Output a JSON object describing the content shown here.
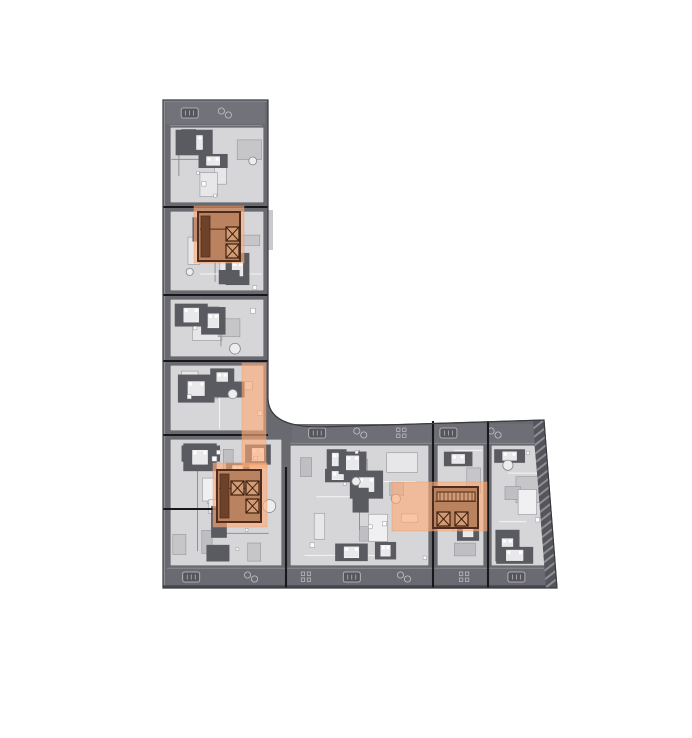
{
  "page": {
    "background": "#ffffff"
  },
  "palette": {
    "shell": "#696970",
    "shell_stroke": "#3a3a40",
    "interior": "#d6d6d8",
    "interior_stroke": "#4f4f56",
    "room_fills": [
      "#c6c6c9",
      "#e7e7e9",
      "#f0f0f2",
      "#bfbfc3"
    ],
    "room_stroke": "#97979d",
    "dark_block": "#5a5a61",
    "bed_fill": "#e9e9eb",
    "wall_line": "#8f8f95",
    "light_line": "#f4f4f6",
    "circle_fill": "#ededef",
    "circle_stroke": "#86868c",
    "tiny_fill": "#fbfbfc",
    "tiny_stroke": "#9a9aa0",
    "band_detail": "#c3c3c7",
    "band_dark": "#55555c",
    "divider": "#18181c",
    "hatch_base": "#54545b",
    "hatch_stripe": "#8e8e94",
    "edge_light": "#9c9ca2",
    "edge_mid": "#8c8c92",
    "edge_dark": "#47474d",
    "sliver": "#c9c9cc",
    "highlight": "#ffab74",
    "highlight_opacity": 0.62,
    "highlight_stroke": "#e09a70",
    "core": {
      "floor": "#bb8260",
      "wall": "#4e2d1e",
      "box": "#d49a73",
      "x": "#3c2212",
      "cab": "#6e4129",
      "box_w": 13,
      "box_h": 14
    }
  },
  "floorplan": {
    "canvas": {
      "w": 692,
      "h": 738
    },
    "outline_path": "M 163,100 L 268,100 L 268,398 Q 268,427 320,427 L 544,420 L 557,588 L 163,588 Z",
    "hatch_polygon": "533,421 544,420 557,588 546,588",
    "modules": [
      {
        "id": "m1",
        "x": 170,
        "y": 127,
        "w": 94,
        "h": 76,
        "seed": 101
      },
      {
        "id": "m2",
        "x": 170,
        "y": 211,
        "w": 94,
        "h": 80,
        "seed": 202
      },
      {
        "id": "m3",
        "x": 170,
        "y": 299,
        "w": 94,
        "h": 58,
        "seed": 303
      },
      {
        "id": "m4",
        "x": 170,
        "y": 365,
        "w": 94,
        "h": 66,
        "seed": 404
      },
      {
        "id": "corner",
        "x": 170,
        "y": 439,
        "w": 112,
        "h": 127,
        "seed": 505
      },
      {
        "id": "h1",
        "x": 290,
        "y": 445,
        "w": 139,
        "h": 121,
        "seed": 606
      },
      {
        "id": "h2",
        "x": 437,
        "y": 445,
        "w": 47,
        "h": 121,
        "seed": 707
      },
      {
        "id": "h3",
        "x": 491,
        "y": 445,
        "w": 55,
        "h": 121,
        "seed": 808,
        "clip": "491,445 535,445 546,566 491,566"
      }
    ],
    "bands": [
      {
        "id": "top-terrace",
        "x": 166,
        "y": 102,
        "w": 99,
        "h": 22,
        "seed": 11,
        "step": 34,
        "fill": "#72727a"
      },
      {
        "id": "south-terrace",
        "x": 292,
        "y": 424,
        "w": 244,
        "h": 18,
        "seed": 22,
        "step": 48,
        "fill": "#6e6e76"
      },
      {
        "id": "bottom-facade",
        "x": 167,
        "y": 569,
        "w": 382,
        "h": 16,
        "seed": 33,
        "step": 52,
        "fill": "#6a6a72"
      }
    ],
    "dividers": [
      [
        163,
        207,
        268,
        207
      ],
      [
        163,
        295,
        268,
        295
      ],
      [
        163,
        361,
        268,
        361
      ],
      [
        163,
        435,
        268,
        435
      ],
      [
        163,
        509,
        217,
        509
      ],
      [
        286,
        467,
        286,
        588
      ],
      [
        433,
        421,
        433,
        588
      ],
      [
        488,
        421,
        488,
        588
      ]
    ],
    "accents": [
      {
        "type": "line",
        "x1": 164.2,
        "y1": 101,
        "x2": 164.2,
        "y2": 587,
        "color": "edge_light",
        "w": 1.1
      },
      {
        "type": "line",
        "x1": 164,
        "y1": 101,
        "x2": 267,
        "y2": 101,
        "color": "edge_light",
        "w": 1
      },
      {
        "type": "line",
        "x1": 167,
        "y1": 568.3,
        "x2": 550,
        "y2": 568.3,
        "color": "edge_mid",
        "w": 1
      },
      {
        "type": "line",
        "x1": 290,
        "y1": 443.3,
        "x2": 537,
        "y2": 443.3,
        "color": "edge_mid",
        "w": 1
      },
      {
        "type": "line",
        "x1": 170,
        "y1": 125.5,
        "x2": 262,
        "y2": 125.5,
        "color": "edge_mid",
        "w": 1
      },
      {
        "type": "line",
        "x1": 163,
        "y1": 586.6,
        "x2": 556,
        "y2": 586.6,
        "color": "edge_dark",
        "w": 2.8
      },
      {
        "type": "rect",
        "x": 268,
        "y": 210,
        "w": 5,
        "h": 40,
        "color": "sliver"
      }
    ],
    "zones": [
      {
        "id": "corridor",
        "x": 242,
        "y": 363,
        "w": 24,
        "h": 104
      },
      {
        "id": "core-1-zone",
        "x": 194,
        "y": 206,
        "w": 50,
        "h": 57
      },
      {
        "id": "core-2-zone",
        "x": 213,
        "y": 463,
        "w": 54,
        "h": 64
      },
      {
        "id": "core-3-zone",
        "x": 392,
        "y": 482,
        "w": 95,
        "h": 49
      }
    ],
    "cores": [
      {
        "id": "core-1",
        "x": 198,
        "y": 212,
        "w": 42,
        "h": 49,
        "elevators": [
          [
            226,
            227
          ],
          [
            226,
            244
          ]
        ],
        "cabs": [
          [
            201,
            216,
            9,
            41
          ]
        ]
      },
      {
        "id": "core-2",
        "x": 217,
        "y": 470,
        "w": 44,
        "h": 52,
        "elevators": [
          [
            231,
            481
          ],
          [
            246,
            481
          ],
          [
            246,
            499
          ]
        ],
        "cabs": [
          [
            220,
            474,
            9,
            44
          ]
        ]
      },
      {
        "id": "core-3",
        "x": 433,
        "y": 487,
        "w": 45,
        "h": 41,
        "elevators": [
          [
            437,
            512
          ],
          [
            455,
            512
          ]
        ],
        "stair": [
          437,
          492,
          38,
          9
        ],
        "cabs": []
      }
    ]
  }
}
